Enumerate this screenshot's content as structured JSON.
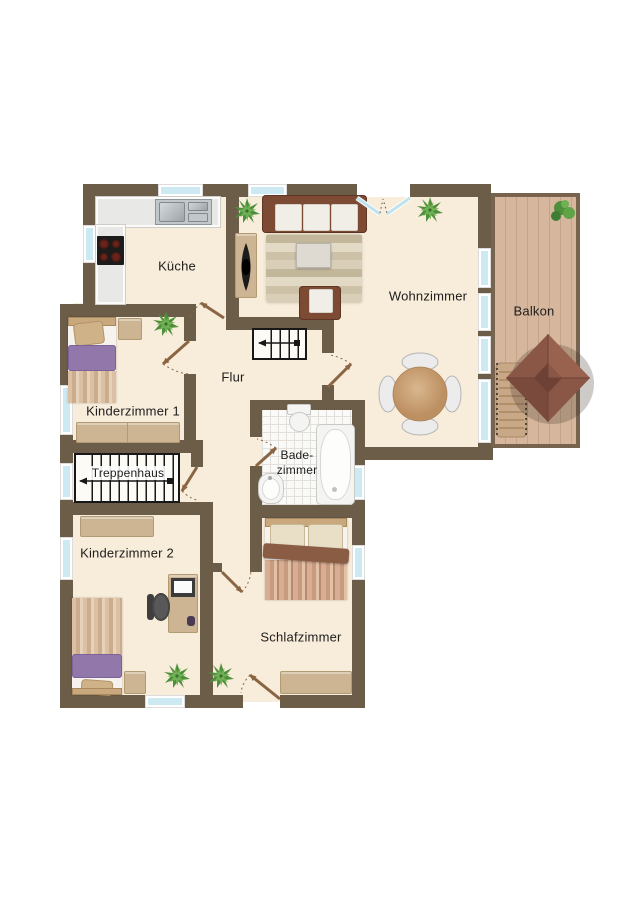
{
  "floorplan": {
    "title": "Obergeschoss Grundriss",
    "rooms": {
      "kueche": "Küche",
      "wohnzimmer": "Wohnzimmer",
      "balkon": "Balkon",
      "kinderzimmer1": "Kinderzimmer 1",
      "flur": "Flur",
      "treppenhaus": "Treppenhaus",
      "kinderzimmer2": "Kinderzimmer 2",
      "badezimmer_line1": "Bade-",
      "badezimmer_line2": "zimmer",
      "schlafzimmer": "Schlafzimmer"
    },
    "palette": {
      "wall": "#6c5d49",
      "floor": "#f8ecda",
      "balcony_deck": "#d6b79d",
      "window_glass": "#cdeaf2",
      "door_swing": "#8a6543",
      "sofa_frame": "#7d4b33",
      "furniture_wood": "#cdb593",
      "blanket_purple": "#9277ab",
      "plant_green": "#5ea346",
      "parasol": "#8a5645",
      "stairs_line": "#181818"
    }
  }
}
